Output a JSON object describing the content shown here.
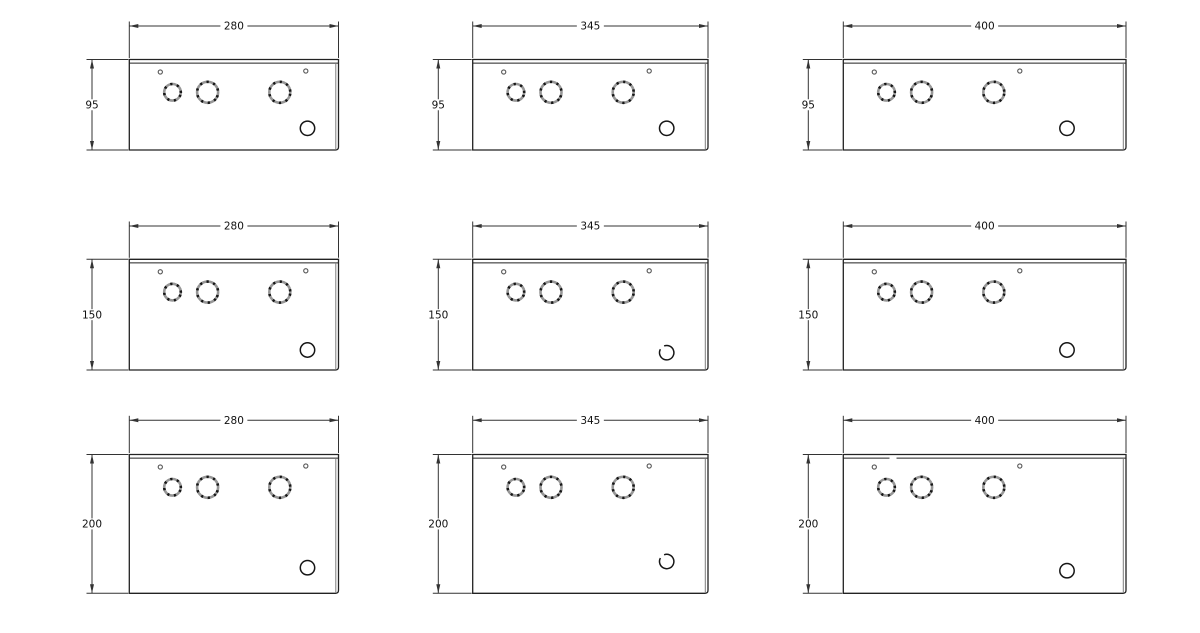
{
  "canvas": {
    "width": 1200,
    "height": 633,
    "background": "#ffffff"
  },
  "colors": {
    "ink": "#222222",
    "dim": "#333333",
    "ring_gray": "#979797",
    "lid_edge_gray": "#7d7d7d",
    "label": "#111111"
  },
  "hole_types": {
    "small": "screw-hole",
    "ring": "knockout-ring",
    "corner": "cable-entry-hole"
  },
  "drawing": {
    "cells": [
      {
        "width_label": "280",
        "height_label": "95"
      },
      {
        "width_label": "345",
        "height_label": "95"
      },
      {
        "width_label": "400",
        "height_label": "95"
      },
      {
        "width_label": "280",
        "height_label": "150"
      },
      {
        "width_label": "345",
        "height_label": "150"
      },
      {
        "width_label": "400",
        "height_label": "150"
      },
      {
        "width_label": "280",
        "height_label": "200"
      },
      {
        "width_label": "345",
        "height_label": "200"
      },
      {
        "width_label": "400",
        "height_label": "200"
      }
    ]
  }
}
